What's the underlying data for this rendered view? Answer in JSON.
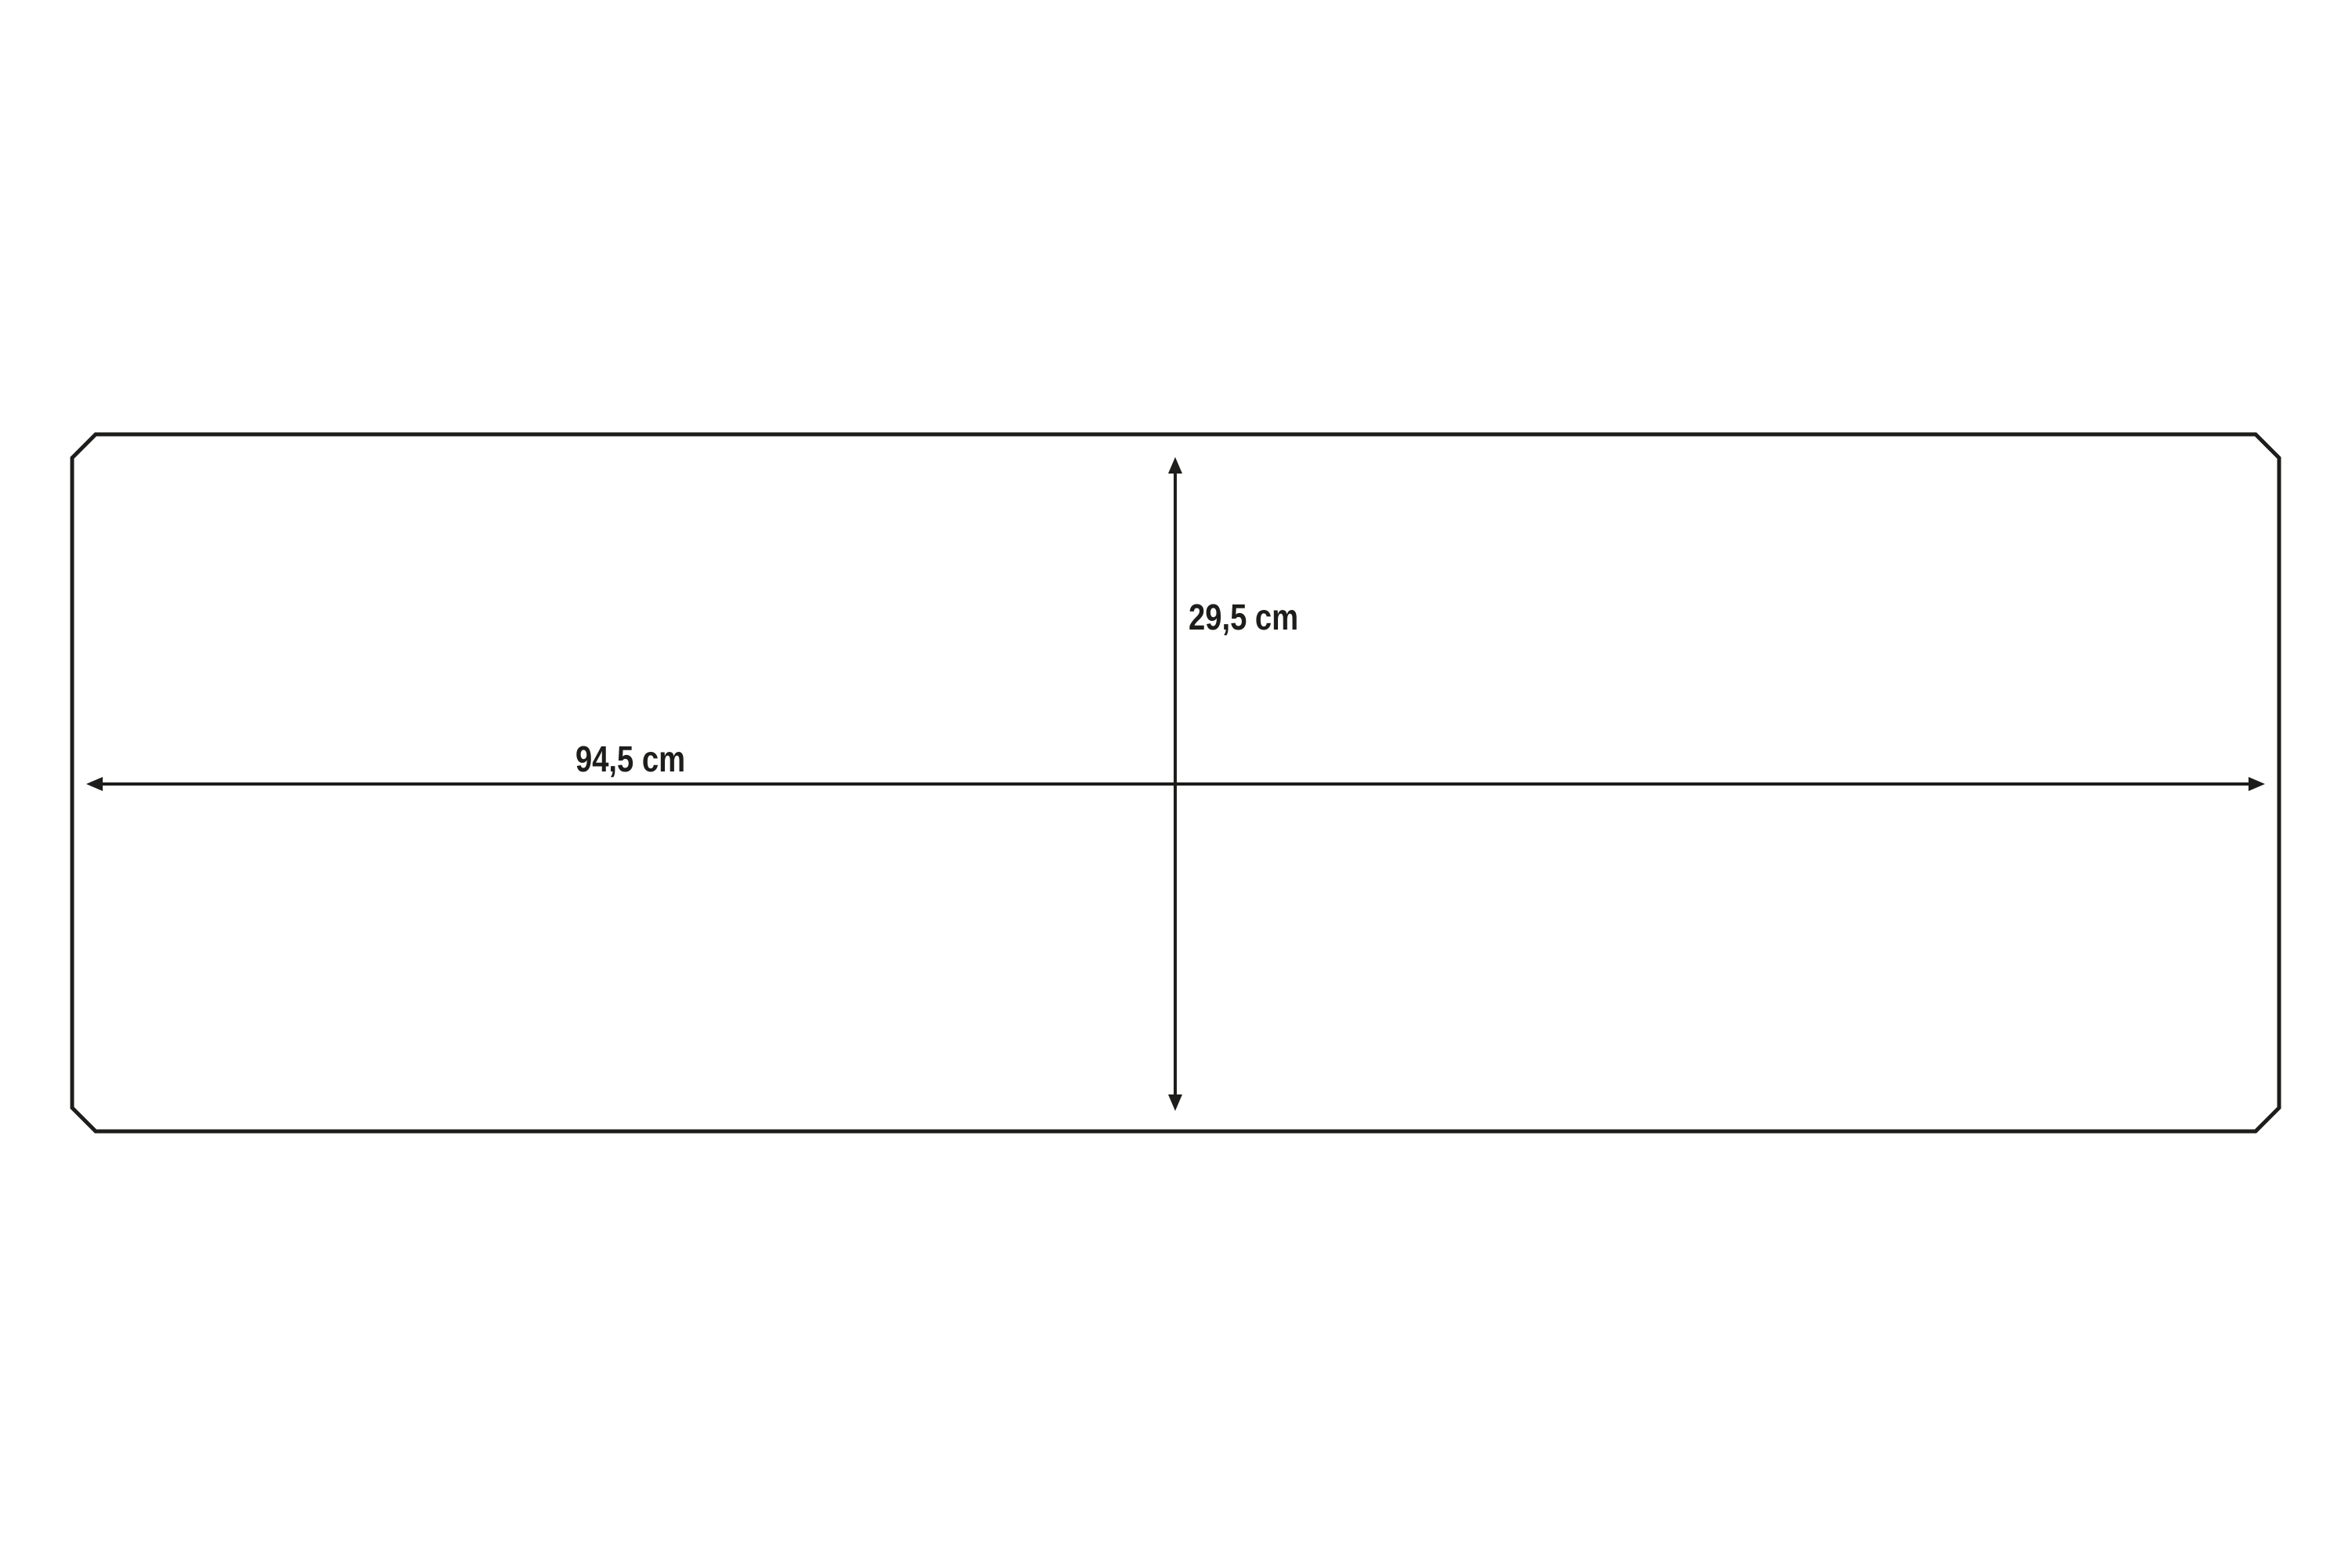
{
  "colors": {
    "background": "#ffffff",
    "line": "#1d1d1b",
    "text": "#1d1d1b"
  },
  "dimensions": {
    "width": {
      "label": "94,5 cm"
    },
    "height": {
      "label": "29,5 cm"
    }
  }
}
